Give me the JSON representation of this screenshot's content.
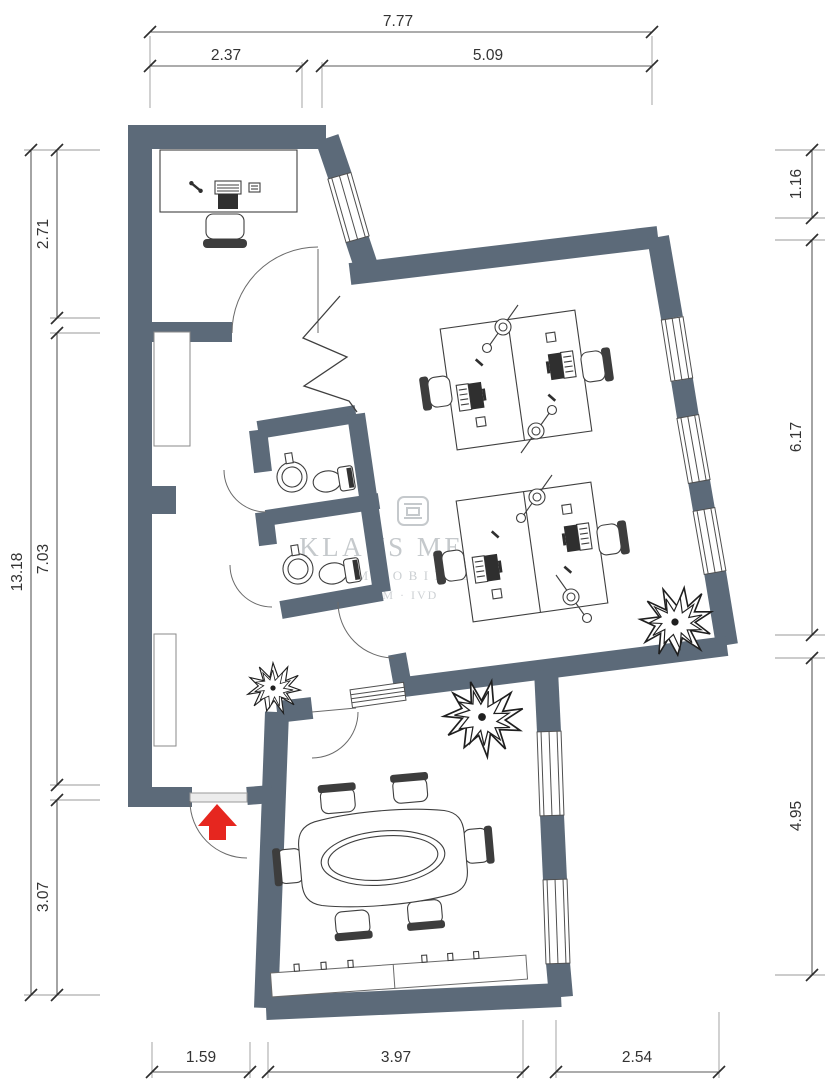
{
  "drawing": {
    "kind": "floor-plan",
    "style": "architectural plan with dimension chains"
  },
  "dims": {
    "top": {
      "total": "7.77",
      "segs": [
        "2.37",
        "5.09"
      ]
    },
    "left": {
      "total": "13.18",
      "segs": [
        "2.71",
        "7.03",
        "3.07"
      ]
    },
    "right": {
      "segs": [
        "1.16",
        "6.17",
        "4.95"
      ]
    },
    "bottom": {
      "segs": [
        "1.59",
        "3.97",
        "2.54"
      ]
    }
  },
  "watermark": {
    "name": "KLAUS MEYER",
    "sub": "IMMOBILIEN",
    "assoc": "BDM · IVD"
  },
  "colors": {
    "wall": "#5c6a79",
    "entrance_arrow": "#e6261f",
    "drawing_lines": "#3f3f3f",
    "dimension_text": "#333333",
    "watermark": "#c5c9cc"
  },
  "icons": [
    "entrance-arrow-icon",
    "desk-icon",
    "office-chair-icon",
    "desk-lamp-icon",
    "monitor-keyboard-icon",
    "phone-icon",
    "toilet-icon",
    "washbasin-icon",
    "conference-table-icon",
    "plant-icon",
    "window-icon",
    "door-arc-icon",
    "brand-logo-icon"
  ]
}
